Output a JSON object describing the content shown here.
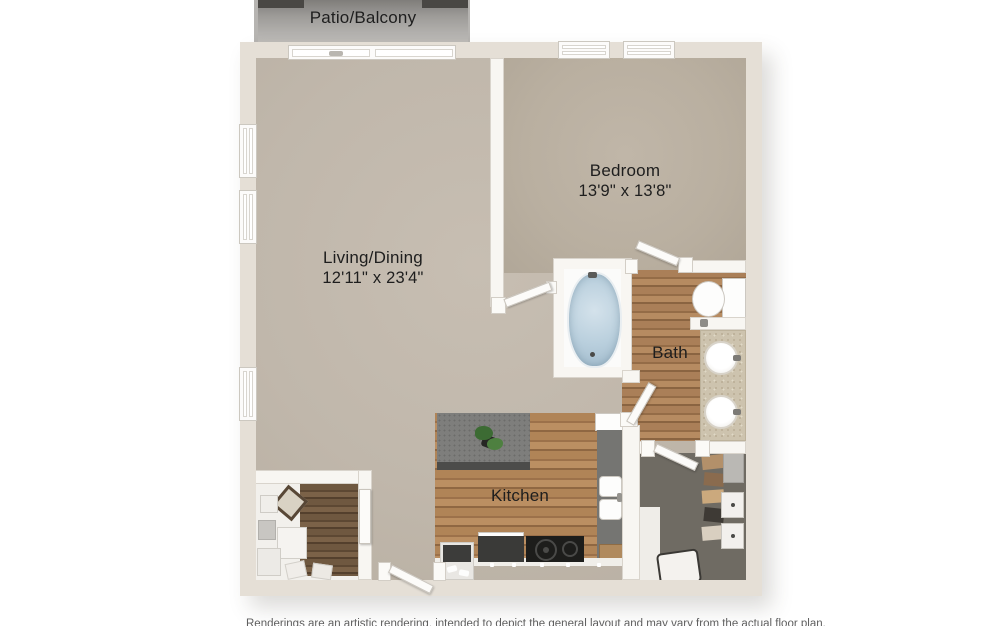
{
  "floorplan": {
    "patio": {
      "label": "Patio/Balcony"
    },
    "rooms": [
      {
        "id": "bedroom",
        "label": "Bedroom",
        "dimensions": "13'9\" x 13'8\""
      },
      {
        "id": "living",
        "label": "Living/Dining",
        "dimensions": "12'11\" x 23'4\""
      },
      {
        "id": "bath",
        "label": "Bath",
        "dimensions": ""
      },
      {
        "id": "kitchen",
        "label": "Kitchen",
        "dimensions": ""
      }
    ],
    "disclaimer": "Renderings are an artistic rendering, intended to depict the general layout and may vary from the actual floor plan.",
    "colors": {
      "wall_exterior": "#e5dfd6",
      "wall_interior": "#f8f6f2",
      "carpet_living": "#c0b7ab",
      "carpet_bedroom": "#b9afa0",
      "wood_floor": "#a57a53",
      "closet_carpet": "#6f6b63",
      "patio_concrete": "#9e9c99",
      "tub_water": "#b9cfdd",
      "counter_island": "#7e7e7c",
      "counter_dark": "#3a3a38",
      "vanity_top": "#cdc3ae",
      "label_text": "#1e1e1e"
    }
  }
}
